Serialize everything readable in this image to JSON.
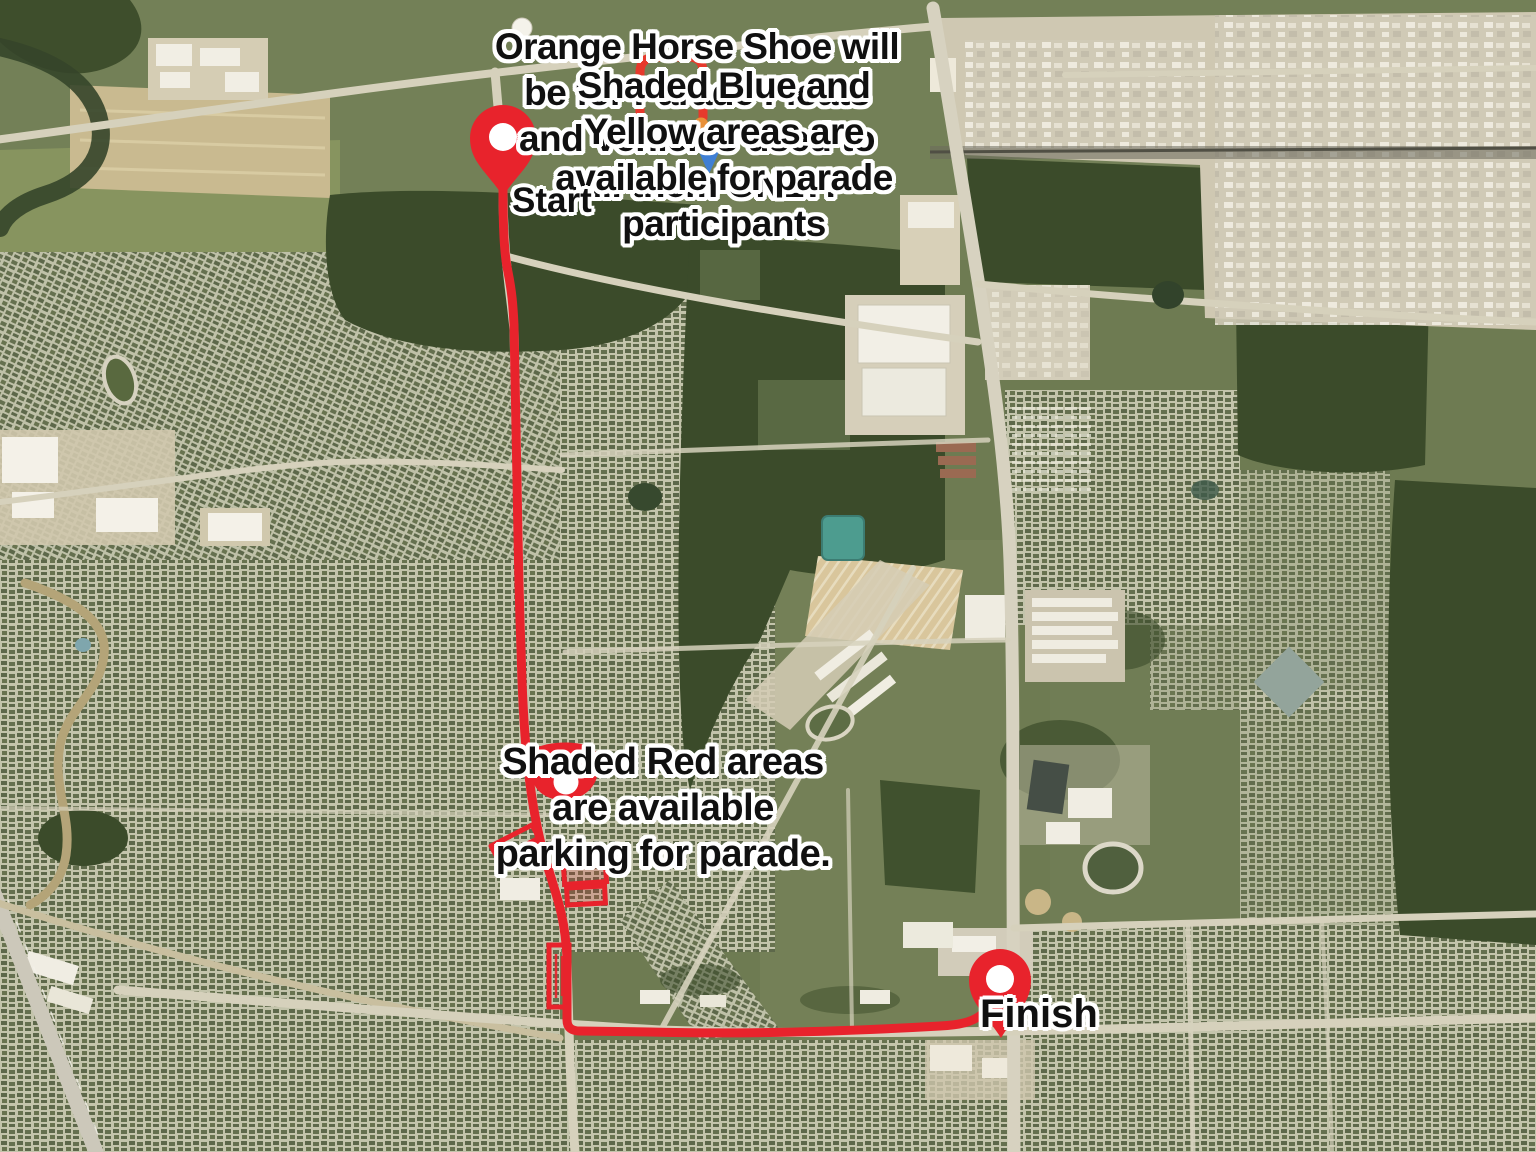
{
  "map": {
    "kind": "satellite-parade-route-map",
    "colors": {
      "route_red": "#e8232c",
      "shaded_blue": "#3f7fd4",
      "shaded_yellow": "#e5d14f",
      "shaded_orange": "#e89038"
    }
  },
  "markers": {
    "start": {
      "label": "Start"
    },
    "finish": {
      "label": "Finish"
    }
  },
  "annotations": {
    "orange_note": {
      "lines": [
        "Orange Horse Shoe will",
        "be for Parade Floats",
        "and Vehicles used to",
        "pull them ONLY!"
      ]
    },
    "blue_yellow_note": {
      "lines": [
        "Shaded Blue and",
        "Yellow areas are",
        "available for parade",
        "participants"
      ]
    },
    "red_note": {
      "lines": [
        "Shaded Red areas",
        "are available",
        "parking for parade."
      ]
    }
  }
}
